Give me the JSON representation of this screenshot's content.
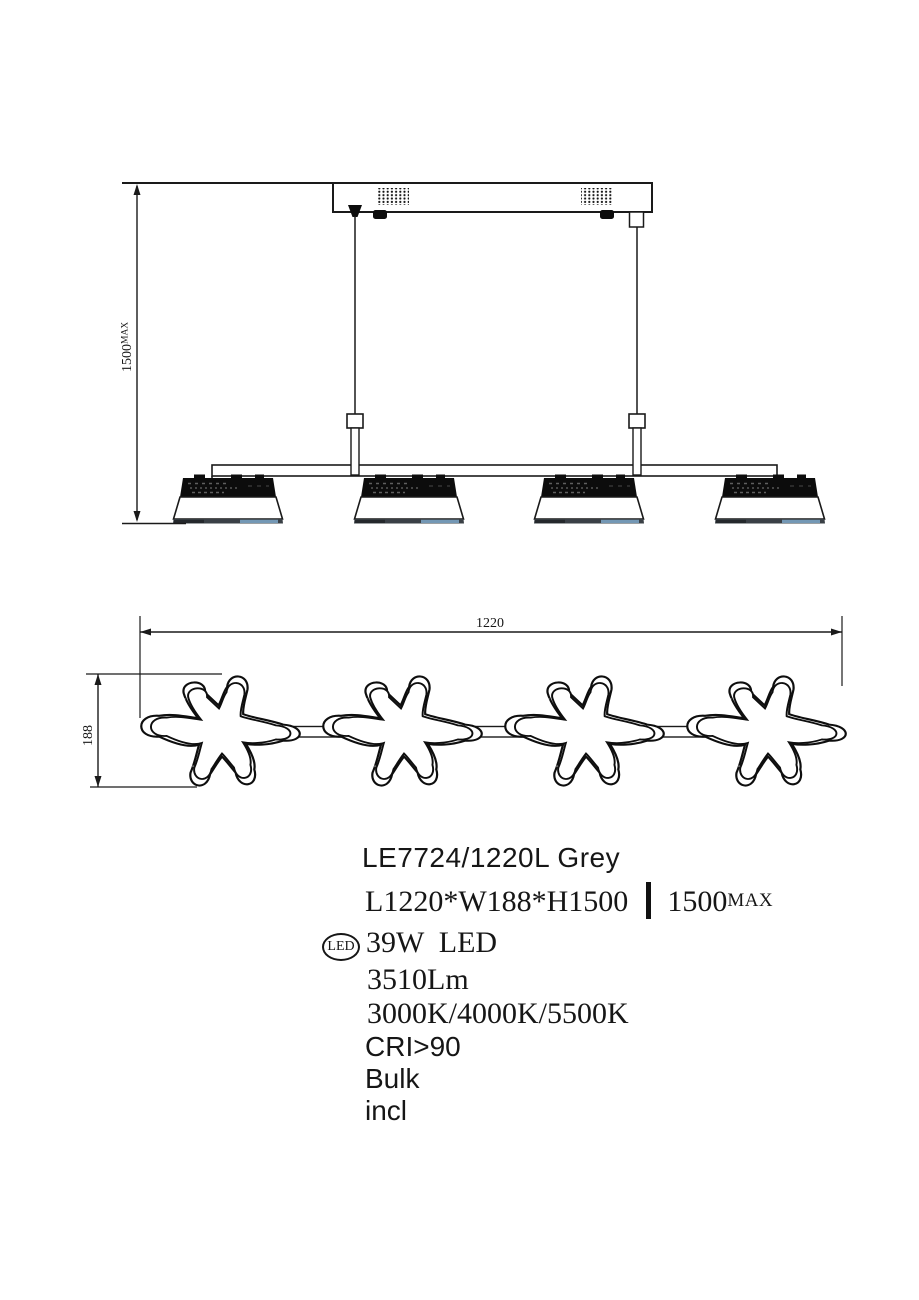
{
  "side_view": {
    "height_dim": {
      "value": "1500",
      "suffix": "MAX"
    }
  },
  "plan_view": {
    "length_dim": "1220",
    "width_dim": "188"
  },
  "specs": {
    "model": "LE7724/1220L Grey",
    "size": "L1220*W188*H1500",
    "height_value": "1500",
    "height_suffix": "MAX",
    "led_badge": "LED",
    "power": "39W  LED",
    "luminous_flux": "3510Lm",
    "color_temperature": "3000K/4000K/5500K",
    "cri": "CRI>90",
    "line_bulk": "Bulk",
    "line_incl": "incl"
  },
  "colors": {
    "line": "#1a1a1a",
    "shade_black": "#0c0c0c",
    "rim_dark": "#3a4046",
    "rim_blue": "#7fa8c9",
    "background": "#ffffff"
  }
}
